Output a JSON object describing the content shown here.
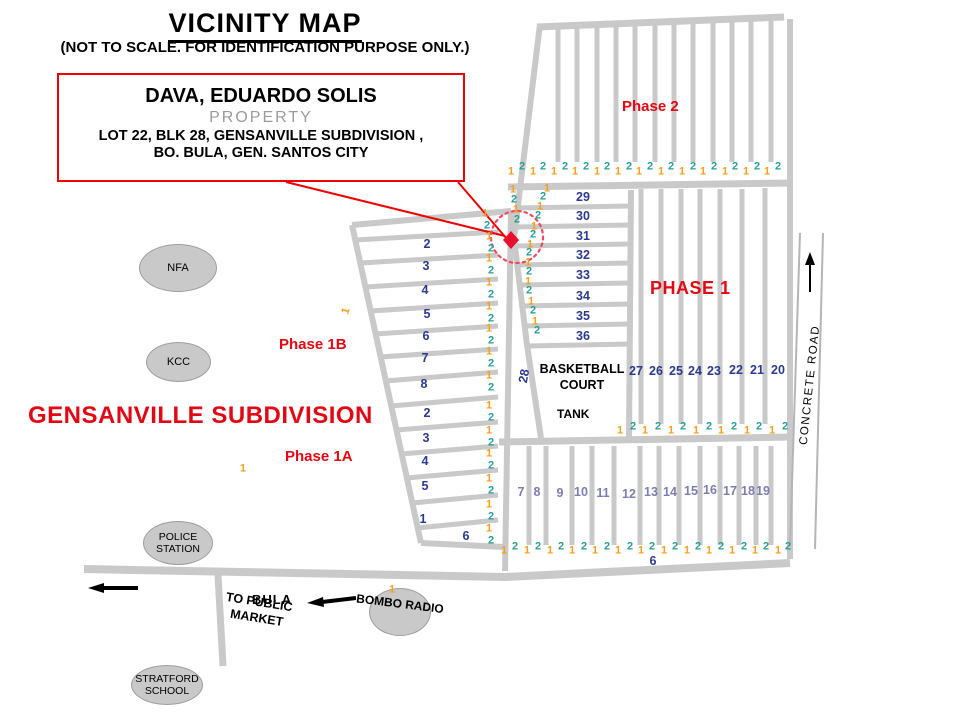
{
  "colors": {
    "accent_red": "#e30613",
    "navy_number": "#2b3a8f",
    "slate_number": "#7d7db2",
    "orange_number": "#f59f1c",
    "teal_number": "#2a9d96",
    "road_gray": "#c9c9c9",
    "ellipse_gray": "#c9c9c9"
  },
  "title": {
    "text": "VICINITY MAP",
    "subtitle": "(NOT TO SCALE. FOR IDENTIFICATION PURPOSE ONLY.)"
  },
  "callout": {
    "owner": "DAVA, EDUARDO SOLIS",
    "property": "PROPERTY",
    "line3": "LOT 22, BLK 28, GENSANVILLE SUBDIVISION ,",
    "line4": "BO. BULA,  GEN. SANTOS CITY"
  },
  "labels": {
    "subdivision": "GENSANVILLE SUBDIVISION",
    "phase2": "Phase 2",
    "phase1": "PHASE 1",
    "phase1b": "Phase 1B",
    "phase1a": "Phase 1A",
    "basketball_court": "BASKETBALL COURT",
    "tank": "TANK",
    "concrete_road": "CONCRETE ROAD",
    "bula": "BULA",
    "to_public_market": "TO PUBLIC MARKET",
    "bombo_radio": "BOMBO RADIO",
    "road_28": "28",
    "rotated_1": "1"
  },
  "places": {
    "nfa": "NFA",
    "kcc": "KCC",
    "police": "POLICE STATION",
    "stratford": "STRATFORD SCHOOL"
  },
  "map_numbers": [
    {
      "t": "29",
      "x": 583,
      "y": 197,
      "c": "n"
    },
    {
      "t": "30",
      "x": 583,
      "y": 216,
      "c": "n"
    },
    {
      "t": "31",
      "x": 583,
      "y": 236,
      "c": "n"
    },
    {
      "t": "32",
      "x": 583,
      "y": 255,
      "c": "n"
    },
    {
      "t": "33",
      "x": 583,
      "y": 275,
      "c": "n"
    },
    {
      "t": "34",
      "x": 583,
      "y": 296,
      "c": "n"
    },
    {
      "t": "35",
      "x": 583,
      "y": 316,
      "c": "n"
    },
    {
      "t": "36",
      "x": 583,
      "y": 336,
      "c": "n"
    },
    {
      "t": "27",
      "x": 636,
      "y": 371,
      "c": "n"
    },
    {
      "t": "26",
      "x": 656,
      "y": 371,
      "c": "n"
    },
    {
      "t": "25",
      "x": 676,
      "y": 371,
      "c": "n"
    },
    {
      "t": "24",
      "x": 695,
      "y": 371,
      "c": "n"
    },
    {
      "t": "23",
      "x": 714,
      "y": 371,
      "c": "n"
    },
    {
      "t": "22",
      "x": 736,
      "y": 370,
      "c": "n"
    },
    {
      "t": "21",
      "x": 757,
      "y": 370,
      "c": "n"
    },
    {
      "t": "20",
      "x": 778,
      "y": 370,
      "c": "n"
    },
    {
      "t": "2",
      "x": 427,
      "y": 244,
      "c": "n"
    },
    {
      "t": "3",
      "x": 426,
      "y": 266,
      "c": "n"
    },
    {
      "t": "4",
      "x": 425,
      "y": 290,
      "c": "n"
    },
    {
      "t": "5",
      "x": 427,
      "y": 314,
      "c": "n"
    },
    {
      "t": "6",
      "x": 426,
      "y": 336,
      "c": "n"
    },
    {
      "t": "7",
      "x": 425,
      "y": 358,
      "c": "n"
    },
    {
      "t": "8",
      "x": 424,
      "y": 384,
      "c": "n"
    },
    {
      "t": "2",
      "x": 427,
      "y": 413,
      "c": "n"
    },
    {
      "t": "3",
      "x": 426,
      "y": 438,
      "c": "n"
    },
    {
      "t": "4",
      "x": 425,
      "y": 461,
      "c": "n"
    },
    {
      "t": "5",
      "x": 425,
      "y": 486,
      "c": "n"
    },
    {
      "t": "1",
      "x": 423,
      "y": 519,
      "c": "n"
    },
    {
      "t": "6",
      "x": 466,
      "y": 536,
      "c": "n"
    },
    {
      "t": "6",
      "x": 653,
      "y": 561,
      "c": "n"
    },
    {
      "t": "7",
      "x": 521,
      "y": 492,
      "c": "s"
    },
    {
      "t": "8",
      "x": 537,
      "y": 492,
      "c": "s"
    },
    {
      "t": "9",
      "x": 560,
      "y": 493,
      "c": "s"
    },
    {
      "t": "10",
      "x": 581,
      "y": 492,
      "c": "s"
    },
    {
      "t": "11",
      "x": 603,
      "y": 493,
      "c": "s"
    },
    {
      "t": "12",
      "x": 629,
      "y": 494,
      "c": "s"
    },
    {
      "t": "13",
      "x": 651,
      "y": 492,
      "c": "s"
    },
    {
      "t": "14",
      "x": 670,
      "y": 492,
      "c": "s"
    },
    {
      "t": "15",
      "x": 691,
      "y": 491,
      "c": "s"
    },
    {
      "t": "16",
      "x": 710,
      "y": 490,
      "c": "s"
    },
    {
      "t": "17",
      "x": 730,
      "y": 491,
      "c": "s"
    },
    {
      "t": "18",
      "x": 748,
      "y": 491,
      "c": "s"
    },
    {
      "t": "19",
      "x": 763,
      "y": 491,
      "c": "s"
    },
    {
      "t": "1",
      "x": 511,
      "y": 172,
      "c": "o"
    },
    {
      "t": "2",
      "x": 522,
      "y": 167,
      "c": "t"
    },
    {
      "t": "1",
      "x": 533,
      "y": 172,
      "c": "o"
    },
    {
      "t": "2",
      "x": 543,
      "y": 167,
      "c": "t"
    },
    {
      "t": "1",
      "x": 554,
      "y": 172,
      "c": "o"
    },
    {
      "t": "2",
      "x": 565,
      "y": 167,
      "c": "t"
    },
    {
      "t": "1",
      "x": 575,
      "y": 172,
      "c": "o"
    },
    {
      "t": "2",
      "x": 586,
      "y": 167,
      "c": "t"
    },
    {
      "t": "1",
      "x": 597,
      "y": 172,
      "c": "o"
    },
    {
      "t": "2",
      "x": 607,
      "y": 167,
      "c": "t"
    },
    {
      "t": "1",
      "x": 618,
      "y": 172,
      "c": "o"
    },
    {
      "t": "2",
      "x": 629,
      "y": 167,
      "c": "t"
    },
    {
      "t": "1",
      "x": 639,
      "y": 172,
      "c": "o"
    },
    {
      "t": "2",
      "x": 650,
      "y": 167,
      "c": "t"
    },
    {
      "t": "1",
      "x": 661,
      "y": 172,
      "c": "o"
    },
    {
      "t": "2",
      "x": 671,
      "y": 167,
      "c": "t"
    },
    {
      "t": "1",
      "x": 682,
      "y": 172,
      "c": "o"
    },
    {
      "t": "2",
      "x": 693,
      "y": 167,
      "c": "t"
    },
    {
      "t": "1",
      "x": 703,
      "y": 172,
      "c": "o"
    },
    {
      "t": "2",
      "x": 714,
      "y": 167,
      "c": "t"
    },
    {
      "t": "1",
      "x": 725,
      "y": 172,
      "c": "o"
    },
    {
      "t": "2",
      "x": 735,
      "y": 167,
      "c": "t"
    },
    {
      "t": "1",
      "x": 746,
      "y": 172,
      "c": "o"
    },
    {
      "t": "2",
      "x": 757,
      "y": 167,
      "c": "t"
    },
    {
      "t": "1",
      "x": 767,
      "y": 172,
      "c": "o"
    },
    {
      "t": "2",
      "x": 778,
      "y": 167,
      "c": "t"
    },
    {
      "t": "1",
      "x": 620,
      "y": 431,
      "c": "o"
    },
    {
      "t": "2",
      "x": 633,
      "y": 427,
      "c": "t"
    },
    {
      "t": "1",
      "x": 645,
      "y": 431,
      "c": "o"
    },
    {
      "t": "2",
      "x": 658,
      "y": 427,
      "c": "t"
    },
    {
      "t": "1",
      "x": 671,
      "y": 431,
      "c": "o"
    },
    {
      "t": "2",
      "x": 683,
      "y": 427,
      "c": "t"
    },
    {
      "t": "1",
      "x": 696,
      "y": 431,
      "c": "o"
    },
    {
      "t": "2",
      "x": 709,
      "y": 427,
      "c": "t"
    },
    {
      "t": "1",
      "x": 721,
      "y": 431,
      "c": "o"
    },
    {
      "t": "2",
      "x": 734,
      "y": 427,
      "c": "t"
    },
    {
      "t": "1",
      "x": 747,
      "y": 431,
      "c": "o"
    },
    {
      "t": "2",
      "x": 759,
      "y": 427,
      "c": "t"
    },
    {
      "t": "1",
      "x": 772,
      "y": 431,
      "c": "o"
    },
    {
      "t": "2",
      "x": 785,
      "y": 427,
      "c": "t"
    },
    {
      "t": "1",
      "x": 504,
      "y": 551,
      "c": "o"
    },
    {
      "t": "2",
      "x": 515,
      "y": 547,
      "c": "t"
    },
    {
      "t": "1",
      "x": 527,
      "y": 551,
      "c": "o"
    },
    {
      "t": "2",
      "x": 538,
      "y": 547,
      "c": "t"
    },
    {
      "t": "1",
      "x": 550,
      "y": 551,
      "c": "o"
    },
    {
      "t": "2",
      "x": 561,
      "y": 547,
      "c": "t"
    },
    {
      "t": "1",
      "x": 572,
      "y": 551,
      "c": "o"
    },
    {
      "t": "2",
      "x": 584,
      "y": 547,
      "c": "t"
    },
    {
      "t": "1",
      "x": 595,
      "y": 551,
      "c": "o"
    },
    {
      "t": "2",
      "x": 607,
      "y": 547,
      "c": "t"
    },
    {
      "t": "1",
      "x": 618,
      "y": 551,
      "c": "o"
    },
    {
      "t": "2",
      "x": 630,
      "y": 547,
      "c": "t"
    },
    {
      "t": "1",
      "x": 641,
      "y": 551,
      "c": "o"
    },
    {
      "t": "2",
      "x": 652,
      "y": 547,
      "c": "t"
    },
    {
      "t": "1",
      "x": 664,
      "y": 551,
      "c": "o"
    },
    {
      "t": "2",
      "x": 675,
      "y": 547,
      "c": "t"
    },
    {
      "t": "1",
      "x": 687,
      "y": 551,
      "c": "o"
    },
    {
      "t": "2",
      "x": 698,
      "y": 547,
      "c": "t"
    },
    {
      "t": "1",
      "x": 709,
      "y": 551,
      "c": "o"
    },
    {
      "t": "2",
      "x": 721,
      "y": 547,
      "c": "t"
    },
    {
      "t": "1",
      "x": 732,
      "y": 551,
      "c": "o"
    },
    {
      "t": "2",
      "x": 744,
      "y": 547,
      "c": "t"
    },
    {
      "t": "1",
      "x": 755,
      "y": 551,
      "c": "o"
    },
    {
      "t": "2",
      "x": 766,
      "y": 547,
      "c": "t"
    },
    {
      "t": "1",
      "x": 778,
      "y": 551,
      "c": "o"
    },
    {
      "t": "2",
      "x": 788,
      "y": 547,
      "c": "t"
    },
    {
      "t": "1",
      "x": 489,
      "y": 237,
      "c": "o"
    },
    {
      "t": "2",
      "x": 491,
      "y": 249,
      "c": "t"
    },
    {
      "t": "1",
      "x": 489,
      "y": 259,
      "c": "o"
    },
    {
      "t": "2",
      "x": 491,
      "y": 271,
      "c": "t"
    },
    {
      "t": "1",
      "x": 489,
      "y": 283,
      "c": "o"
    },
    {
      "t": "2",
      "x": 491,
      "y": 295,
      "c": "t"
    },
    {
      "t": "1",
      "x": 489,
      "y": 307,
      "c": "o"
    },
    {
      "t": "2",
      "x": 491,
      "y": 319,
      "c": "t"
    },
    {
      "t": "1",
      "x": 489,
      "y": 329,
      "c": "o"
    },
    {
      "t": "2",
      "x": 491,
      "y": 341,
      "c": "t"
    },
    {
      "t": "1",
      "x": 489,
      "y": 352,
      "c": "o"
    },
    {
      "t": "2",
      "x": 491,
      "y": 364,
      "c": "t"
    },
    {
      "t": "1",
      "x": 489,
      "y": 376,
      "c": "o"
    },
    {
      "t": "2",
      "x": 491,
      "y": 388,
      "c": "t"
    },
    {
      "t": "1",
      "x": 489,
      "y": 406,
      "c": "o"
    },
    {
      "t": "2",
      "x": 491,
      "y": 418,
      "c": "t"
    },
    {
      "t": "1",
      "x": 489,
      "y": 431,
      "c": "o"
    },
    {
      "t": "2",
      "x": 491,
      "y": 443,
      "c": "t"
    },
    {
      "t": "1",
      "x": 489,
      "y": 454,
      "c": "o"
    },
    {
      "t": "2",
      "x": 491,
      "y": 466,
      "c": "t"
    },
    {
      "t": "1",
      "x": 489,
      "y": 479,
      "c": "o"
    },
    {
      "t": "2",
      "x": 491,
      "y": 491,
      "c": "t"
    },
    {
      "t": "1",
      "x": 489,
      "y": 505,
      "c": "o"
    },
    {
      "t": "2",
      "x": 491,
      "y": 517,
      "c": "t"
    },
    {
      "t": "1",
      "x": 489,
      "y": 529,
      "c": "o"
    },
    {
      "t": "2",
      "x": 491,
      "y": 541,
      "c": "t"
    },
    {
      "t": "1",
      "x": 547,
      "y": 189,
      "c": "o"
    },
    {
      "t": "2",
      "x": 543,
      "y": 197,
      "c": "t"
    },
    {
      "t": "1",
      "x": 540,
      "y": 207,
      "c": "o"
    },
    {
      "t": "2",
      "x": 538,
      "y": 216,
      "c": "t"
    },
    {
      "t": "1",
      "x": 534,
      "y": 227,
      "c": "o"
    },
    {
      "t": "2",
      "x": 533,
      "y": 235,
      "c": "t"
    },
    {
      "t": "1",
      "x": 530,
      "y": 245,
      "c": "o"
    },
    {
      "t": "2",
      "x": 529,
      "y": 253,
      "c": "t"
    },
    {
      "t": "1",
      "x": 528,
      "y": 263,
      "c": "o"
    },
    {
      "t": "2",
      "x": 529,
      "y": 272,
      "c": "t"
    },
    {
      "t": "1",
      "x": 528,
      "y": 282,
      "c": "o"
    },
    {
      "t": "2",
      "x": 529,
      "y": 291,
      "c": "t"
    },
    {
      "t": "1",
      "x": 531,
      "y": 302,
      "c": "o"
    },
    {
      "t": "2",
      "x": 533,
      "y": 311,
      "c": "t"
    },
    {
      "t": "1",
      "x": 535,
      "y": 322,
      "c": "o"
    },
    {
      "t": "2",
      "x": 537,
      "y": 331,
      "c": "t"
    },
    {
      "t": "1",
      "x": 513,
      "y": 190,
      "c": "o"
    },
    {
      "t": "2",
      "x": 514,
      "y": 200,
      "c": "t"
    },
    {
      "t": "1",
      "x": 516,
      "y": 210,
      "c": "o"
    },
    {
      "t": "2",
      "x": 517,
      "y": 220,
      "c": "t"
    },
    {
      "t": "1",
      "x": 485,
      "y": 214,
      "c": "o"
    },
    {
      "t": "2",
      "x": 487,
      "y": 226,
      "c": "t"
    },
    {
      "t": "1",
      "x": 243,
      "y": 469,
      "c": "o"
    },
    {
      "t": "1",
      "x": 392,
      "y": 590,
      "c": "o"
    }
  ]
}
